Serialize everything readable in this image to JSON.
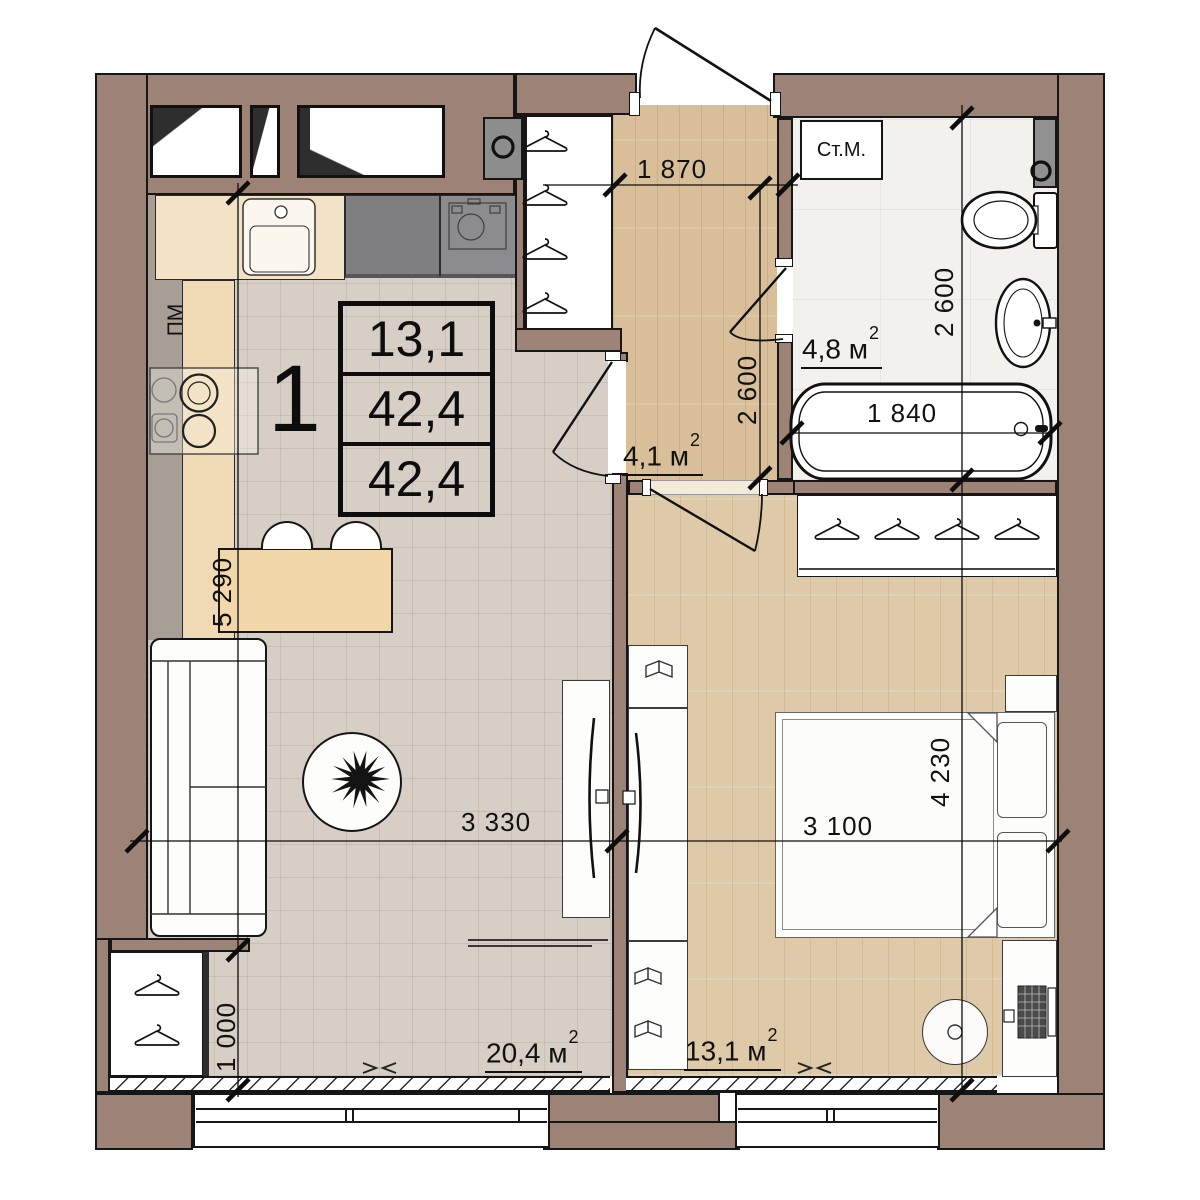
{
  "title": "1-room apartment floor plan",
  "info_box": {
    "room_count": "1",
    "rows": [
      "13,1",
      "42,4",
      "42,4"
    ]
  },
  "areas": {
    "living": {
      "value": "20,4 м",
      "sup": "2"
    },
    "bedroom": {
      "value": "13,1 м",
      "sup": "2"
    },
    "hallway": {
      "value": "4,1 м",
      "sup": "2"
    },
    "bathroom": {
      "value": "4,8 м",
      "sup": "2"
    }
  },
  "appliance_labels": {
    "washing_machine": "Ст.М.",
    "dishwasher": "ПМ"
  },
  "dimensions": {
    "hallway_width": "1 870",
    "hallway_depth": "2 600",
    "bathroom_depth": "2 600",
    "bathtub_length": "1 840",
    "kitchen_living_length": "5 290",
    "living_width": "3 330",
    "bedroom_width": "3 100",
    "bedroom_length": "4 230",
    "closet_depth": "1 000"
  },
  "colors": {
    "wall": "#9c8375",
    "outline": "#161616",
    "tile_floor": "#d7cfc6",
    "wood_floor": "#d8bf9a",
    "bedroom_wood_floor": "#decaa8",
    "bath_floor": "#f2f1ee",
    "counter_wood": "#f2ddb8",
    "counter_gray": "#7f7f81",
    "bar_wood": "#f1d7a9"
  }
}
